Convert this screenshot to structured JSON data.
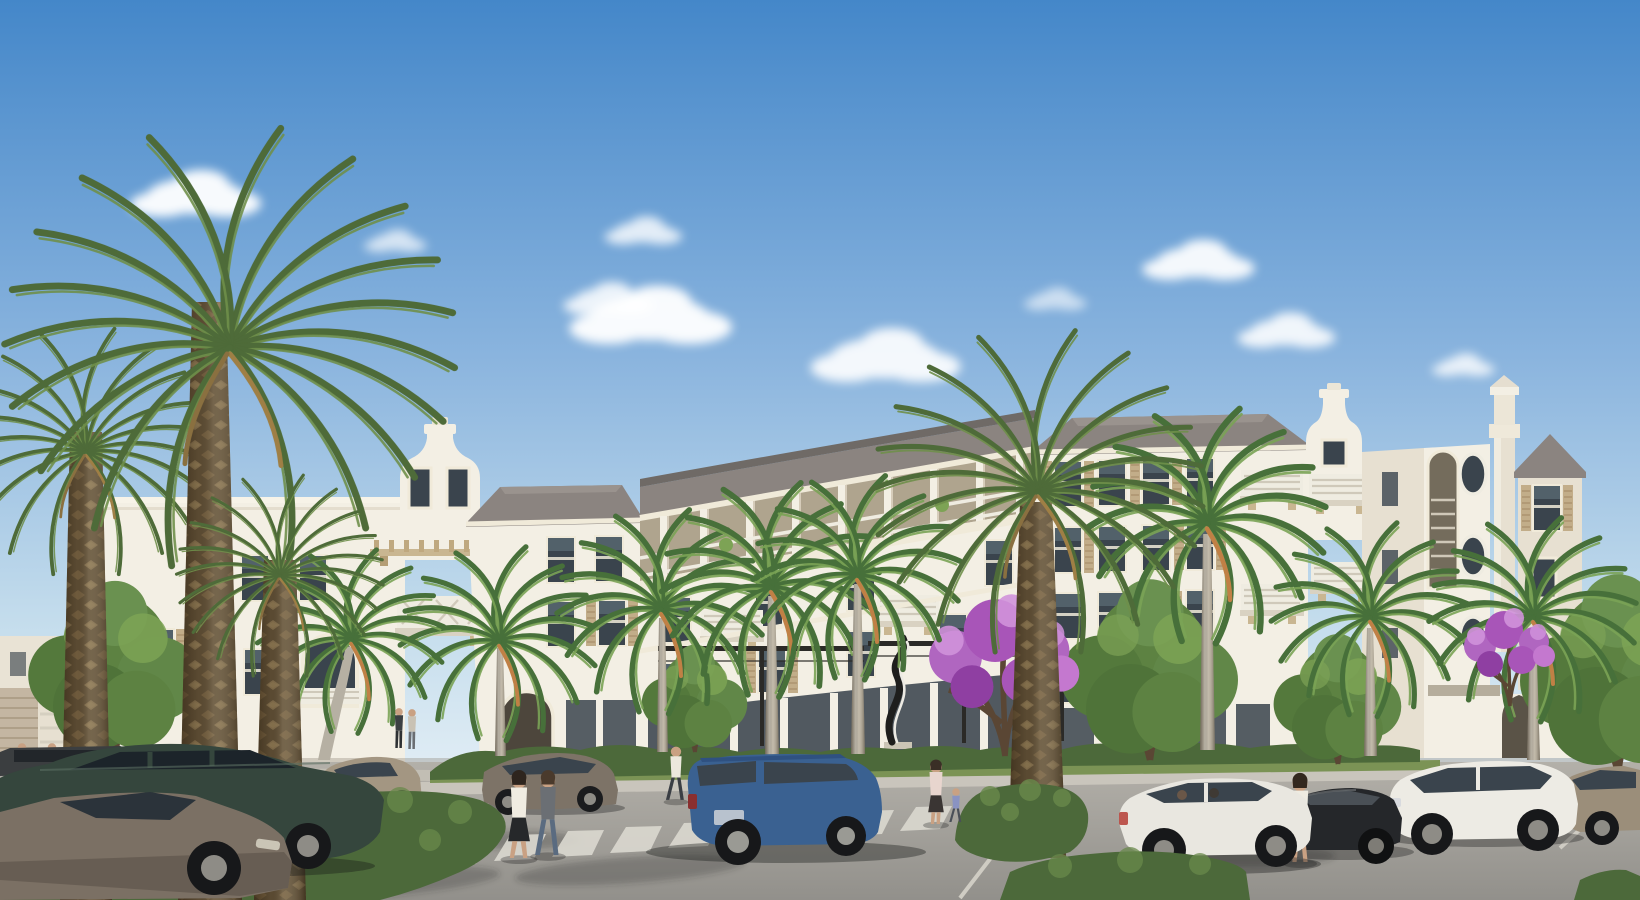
{
  "meta": {
    "title": "Architectural rendering - luxury apartment community street scene",
    "type": "natural-image",
    "render_style": "photorealistic CGI exterior visualization"
  },
  "scene": {
    "description": "Street-level rendering of a four-story white Mediterranean-style apartment building with a curved front, bell-shaped gable parapets and a corner tower, fronted by date palms, royal palms, purple flowering trees, clipped hedge islands, a drive with crosswalk and parked cars, and pedestrians under a blue sky with scattered clouds.",
    "sky": {
      "description": "clear blue sky with scattered white cumulus clouds",
      "cloud_count": 9
    },
    "building": {
      "stories": 4,
      "style": "Mediterranean / Dutch-colonial coastal",
      "features": [
        "curved concave center wing with recessed third-floor colonnade balconies",
        "two bell-shaped Dutch gable parapets",
        "corner tower with corbelled cap",
        "tan louvered shutters",
        "white slat and lattice balcony railings",
        "timber pergola trellis",
        "ground-floor storefront glazing",
        "black metal entry trellis frames",
        "arched openings and oval porthole windows",
        "gothic arched garden-wall opening"
      ]
    },
    "vegetation": {
      "date_palms": 4,
      "royal_palms": 8,
      "coconut_palms": 1,
      "shade_trees": 5,
      "purple_flowering_trees": 2,
      "hedges": "clipped hedge median islands and foundation hedges",
      "grass": "lawn verge along facade"
    },
    "street": [
      "asphalt drive",
      "white crosswalk stripes",
      "painted parking stall lines",
      "concrete sidewalk",
      "hedge median islands"
    ],
    "artwork": "abstract twisted-ribbon sculpture near the entry",
    "vehicle_count": 10,
    "people_count": 11,
    "lighting": "warm late-afternoon sunlight from the left with long soft shadows"
  },
  "palette": {
    "sky_top": "#4487c9",
    "sky_mid": "#8ab4de",
    "sky_low": "#c3dcec",
    "sky_horizon": "#e4eff6",
    "cloud": "#ffffff",
    "wall_light": "#f3efe4",
    "wall_mid": "#e7e0d1",
    "wall_shade": "#d6ccba",
    "fascia": "#f0ead9",
    "roof": "#8b8480",
    "roof_dark": "#6f6a66",
    "glass": "#3a444d",
    "glass_hi": "#72858f",
    "shutter": "#c2ad89",
    "railing": "#efece1",
    "trim": "#d5cfc0",
    "pergola": "#c9b691",
    "metal": "#2b2a27",
    "sculpture_dark": "#1e1e1d",
    "sculpture_light": "#eceae3",
    "brick": "#c4b6a2",
    "road": "#a7a49e",
    "road_near": "#92908b",
    "sidewalk": "#c9c5bc",
    "crosswalk_stripe": "#dad7cf",
    "parking_line": "#cfccc3",
    "grass": "#7b9355",
    "hedge": "#4c693a",
    "hedge_light": "#69894b",
    "tree_green": "#5d8242",
    "tree_light": "#7da355",
    "palm_green": "#4e6b39",
    "palm_light": "#6f8f4a",
    "palm_dry": "#9f7f45",
    "date_bark": "#5a4a32",
    "date_bark_light": "#7c6848",
    "royal_trunk": "#b6b0a3",
    "bloom": "#b066c0",
    "bloom_light": "#d092da",
    "bloom_dark": "#8f3fa2",
    "skin": "#c9a183"
  },
  "vehicles": [
    {
      "id": "parked-sedan-far-left",
      "type": "parked sedan, partially visible",
      "color": "#3b3e40"
    },
    {
      "id": "parked-teal-sedan",
      "type": "dark teal parked sedan",
      "color": "#35463d"
    },
    {
      "id": "parked-gray-sedan",
      "type": "warm gray foreground sedan",
      "color": "#7b7064"
    },
    {
      "id": "parked-tan-compact",
      "type": "tan compact crossover behind hedge",
      "color": "#a39682"
    },
    {
      "id": "parked-bronze-sedan",
      "type": "bronze parked sedan",
      "color": "#7d7367"
    },
    {
      "id": "driving-blue-suv",
      "type": "blue SUV driving past entry",
      "color": "#3a6191"
    },
    {
      "id": "white-hatchback",
      "type": "white hatchback with occupants",
      "color": "#e9e7e0"
    },
    {
      "id": "black-sedan",
      "type": "black coupe sedan",
      "color": "#25272a"
    },
    {
      "id": "white-crossover",
      "type": "white crossover SUV",
      "color": "#edebe4"
    },
    {
      "id": "tan-sedan-far-right",
      "type": "tan sedan, partially visible",
      "color": "#9b8e7a"
    }
  ],
  "people": [
    {
      "id": "man-standing-1",
      "top": "#4a4e52",
      "bottom": "#33363a"
    },
    {
      "id": "man-standing-2",
      "top": "#e9e5da",
      "bottom": "#8a8d92"
    },
    {
      "id": "man-suit-walking",
      "top": "#7d8287",
      "bottom": "#6e7378"
    },
    {
      "id": "pedestrian-pair-a",
      "top": "#3c4043",
      "bottom": "#2e3134"
    },
    {
      "id": "pedestrian-pair-b",
      "top": "#c9c2b4",
      "bottom": "#6b6e72"
    },
    {
      "id": "man-white-shirt-walking",
      "top": "#ece8dd",
      "bottom": "#3a3e44"
    },
    {
      "id": "woman-crosswalk-skirt",
      "top": "#f0ece1",
      "bottom": "#26282a"
    },
    {
      "id": "woman-crosswalk-jeans",
      "top": "#6b6f74",
      "bottom": "#5a6b80"
    },
    {
      "id": "woman-with-child",
      "top": "#e8d5ce",
      "bottom": "#3a3533"
    },
    {
      "id": "child",
      "top": "#8a93c2",
      "bottom": "#4a4f58"
    },
    {
      "id": "woman-by-black-sedan",
      "top": "#eeebe1",
      "bottom": "#2b2d2f"
    }
  ]
}
